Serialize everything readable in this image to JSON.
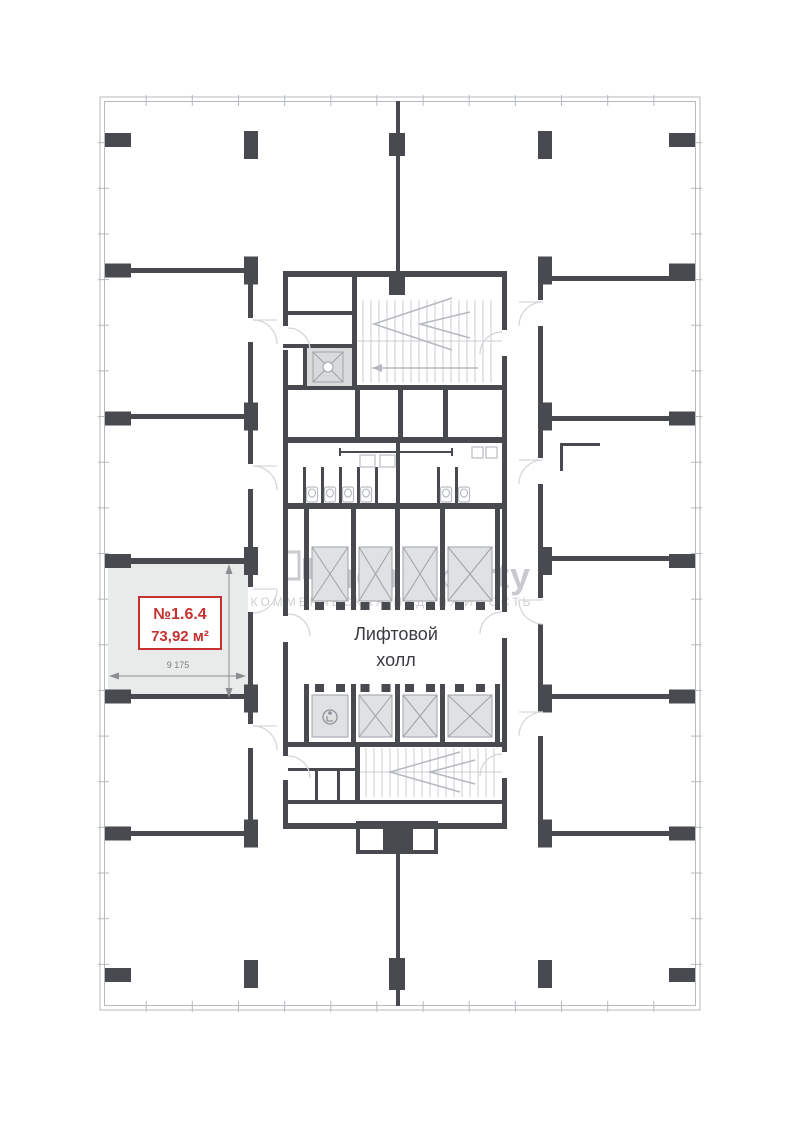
{
  "plan": {
    "title": "floor-plan",
    "unit": {
      "number": "№1.6.4",
      "area": "73,92 м²",
      "dim_width": "9 175",
      "dim_height": "8 200"
    },
    "core": {
      "hall_line1": "Лифтовой",
      "hall_line2": "холл"
    },
    "watermark": {
      "brand": "theproperty",
      "tagline": "КОММЕРЧЕСКАЯ НЕДВИЖИМОСТЬ"
    },
    "icons": {
      "elevator": "elevator-shaft-x-icon",
      "accessible": "wheelchair-icon",
      "toilet": "toilet-icon",
      "stairs": "stair-arrow-icon"
    },
    "colors": {
      "wall": "#494a50",
      "boundary": "#b6b9be",
      "unit_fill": "#e9eaea",
      "accent_red": "#c5322f",
      "watermark": "rgba(125,128,135,0.42)"
    }
  }
}
